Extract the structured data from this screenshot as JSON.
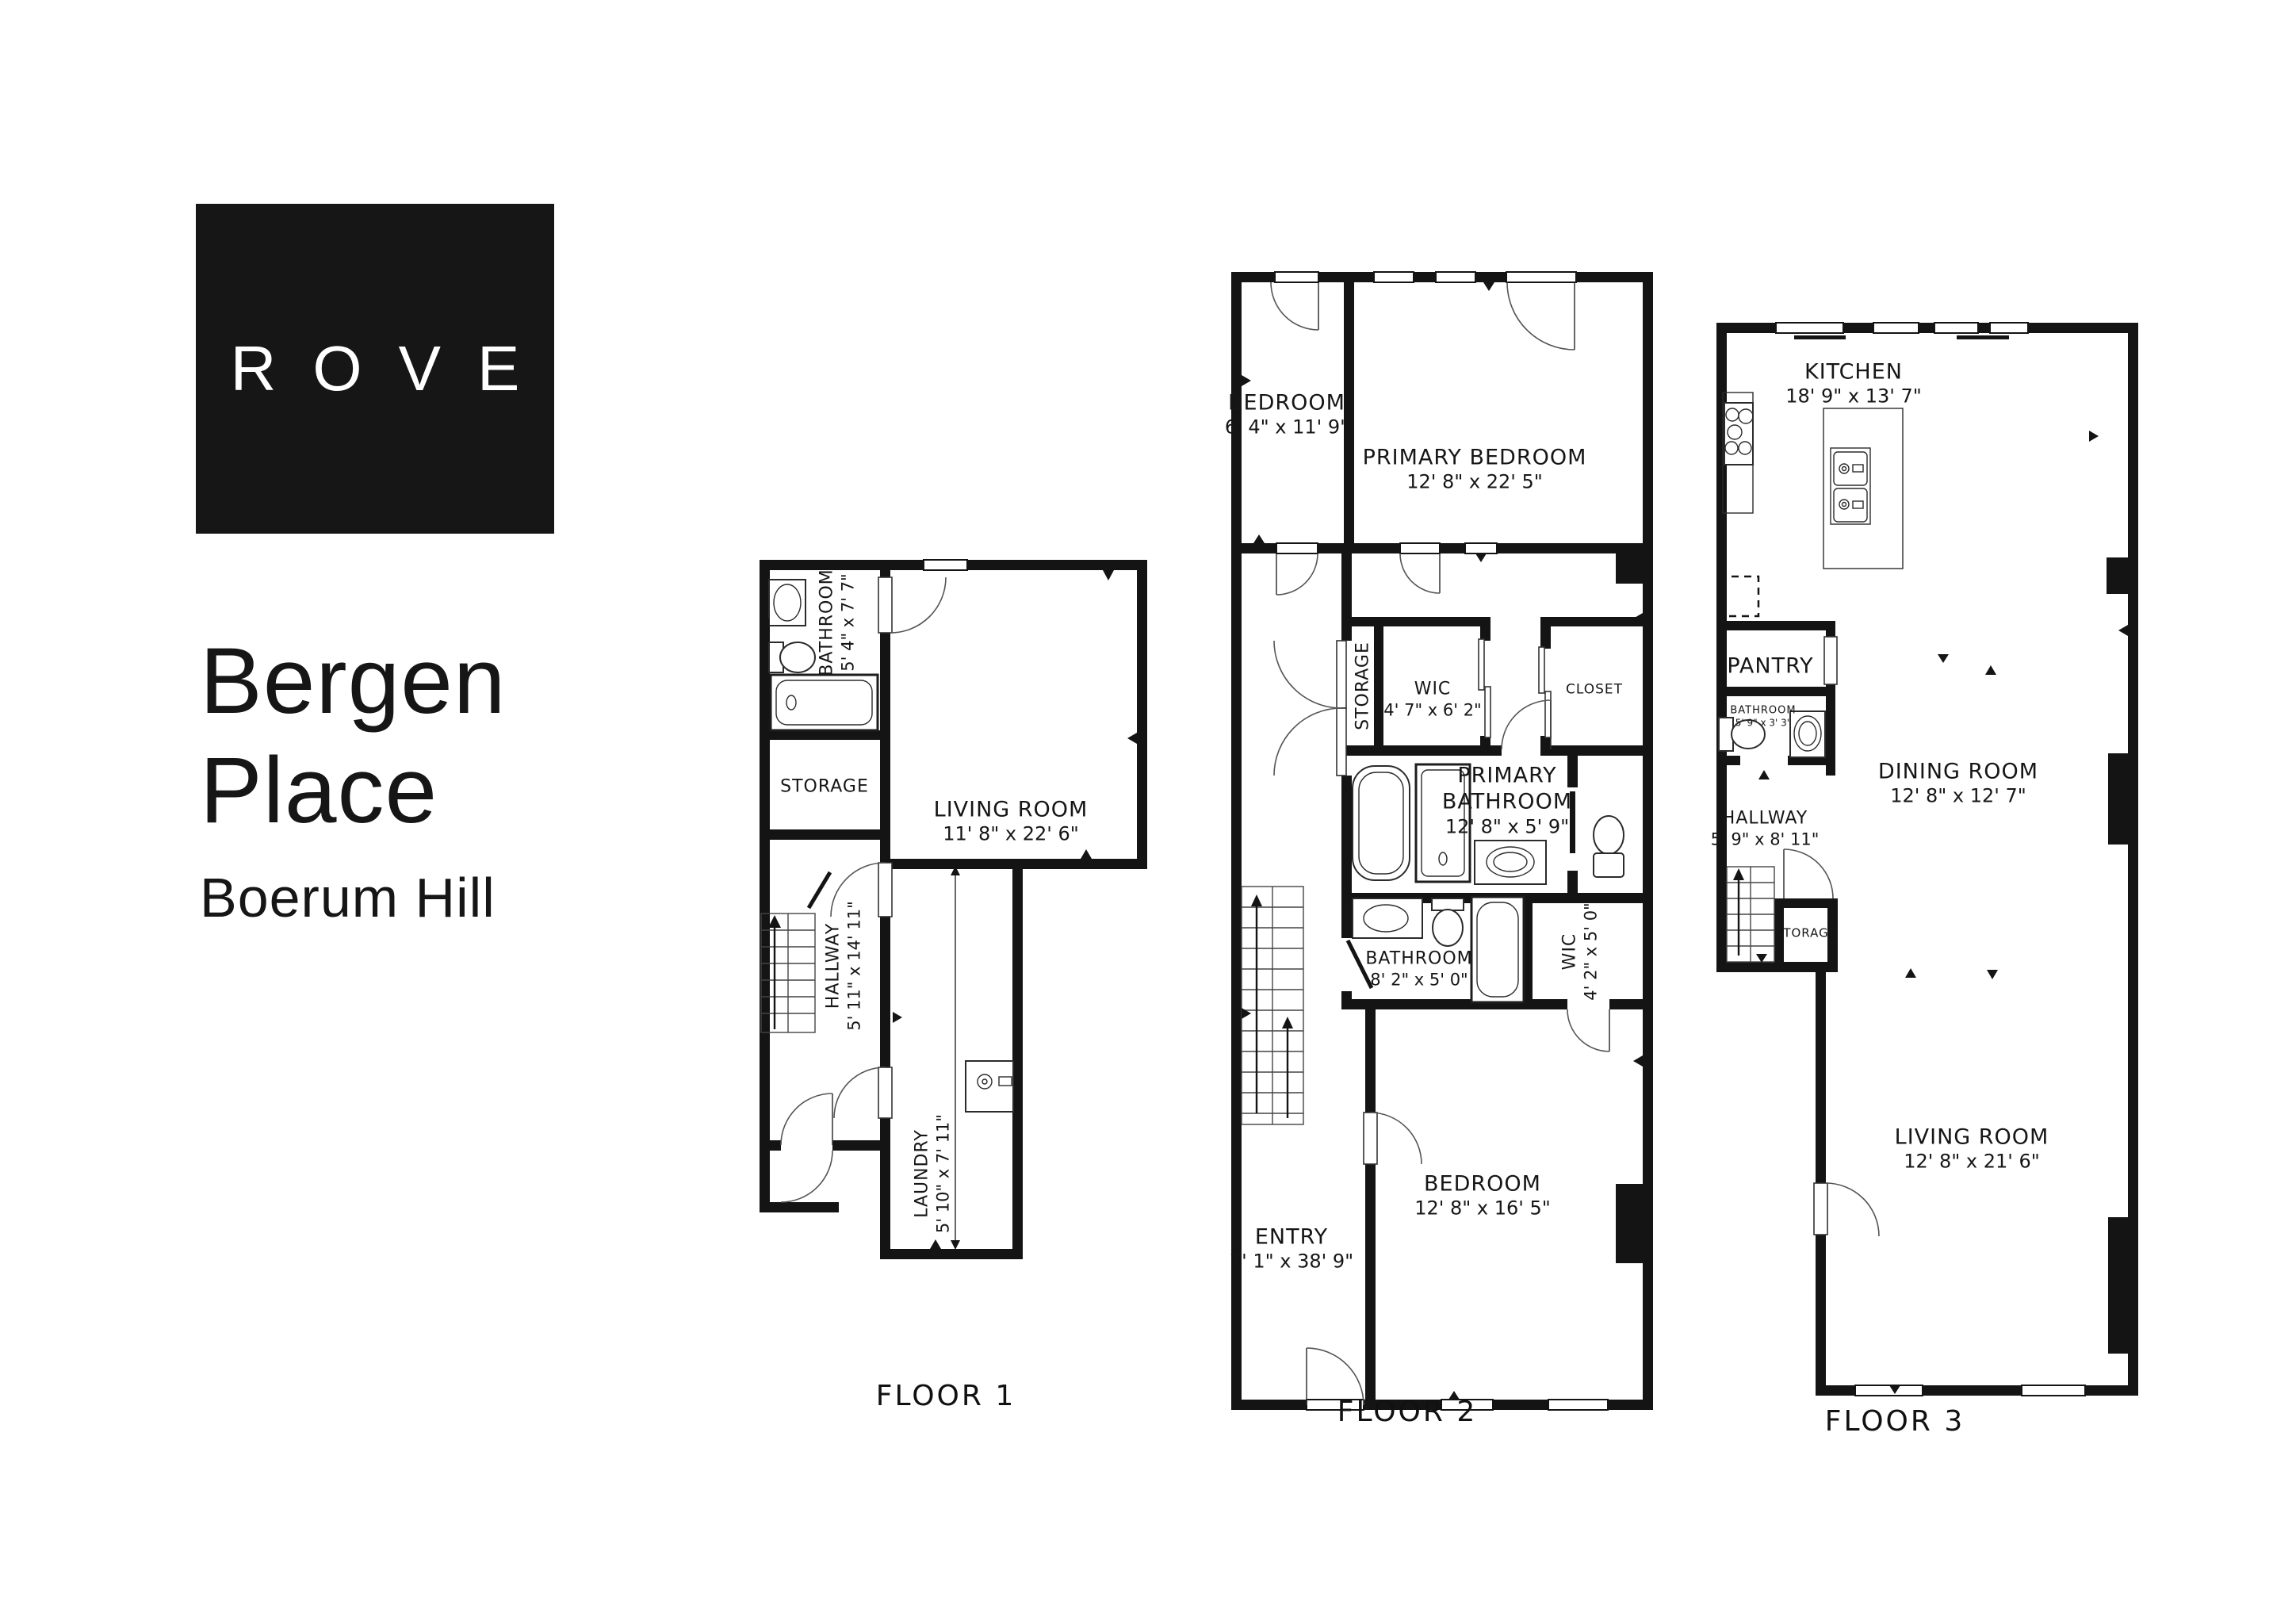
{
  "logo": {
    "text": "ROVE",
    "bg": "#161616",
    "fg": "#ffffff"
  },
  "title": {
    "line1": "Bergen",
    "line2": "Place",
    "subtitle": "Boerum Hill"
  },
  "colors": {
    "wall": "#141414",
    "text": "#161616"
  },
  "floors": [
    {
      "label": "FLOOR 1",
      "rooms": [
        {
          "name": "BATHROOM",
          "dims": "5' 4\" x 7' 7\""
        },
        {
          "name": "STORAGE",
          "dims": ""
        },
        {
          "name": "LIVING ROOM",
          "dims": "11' 8\" x 22' 6\""
        },
        {
          "name": "HALLWAY",
          "dims": "5' 11\" x 14' 11\""
        },
        {
          "name": "LAUNDRY",
          "dims": "5' 10\" x 7' 11\""
        }
      ]
    },
    {
      "label": "FLOOR 2",
      "rooms": [
        {
          "name": "BEDROOM",
          "dims": "6' 4\" x 11' 9\""
        },
        {
          "name": "PRIMARY BEDROOM",
          "dims": "12' 8\" x 22' 5\""
        },
        {
          "name": "STORAGE",
          "dims": ""
        },
        {
          "name": "WIC",
          "dims": "4' 7\" x 6' 2\""
        },
        {
          "name": "CLOSET",
          "dims": ""
        },
        {
          "name": "PRIMARY BATHROOM",
          "dims": "12' 8\" x 5' 9\""
        },
        {
          "name": "BATHROOM",
          "dims": "8' 2\" x 5' 0\""
        },
        {
          "name": "WIC",
          "dims": "4' 2\" x 5' 0\""
        },
        {
          "name": "ENTRY",
          "dims": "7' 1\" x 38' 9\""
        },
        {
          "name": "BEDROOM",
          "dims": "12' 8\" x 16' 5\""
        }
      ]
    },
    {
      "label": "FLOOR 3",
      "rooms": [
        {
          "name": "KITCHEN",
          "dims": "18' 9\" x 13' 7\""
        },
        {
          "name": "PANTRY",
          "dims": ""
        },
        {
          "name": "BATHROOM",
          "dims": "5' 9\" x 3' 3\""
        },
        {
          "name": "HALLWAY",
          "dims": "5' 9\" x 8' 11\""
        },
        {
          "name": "STORAGE",
          "dims": ""
        },
        {
          "name": "DINING ROOM",
          "dims": "12' 8\" x 12' 7\""
        },
        {
          "name": "LIVING ROOM",
          "dims": "12' 8\" x 21' 6\""
        }
      ]
    }
  ]
}
